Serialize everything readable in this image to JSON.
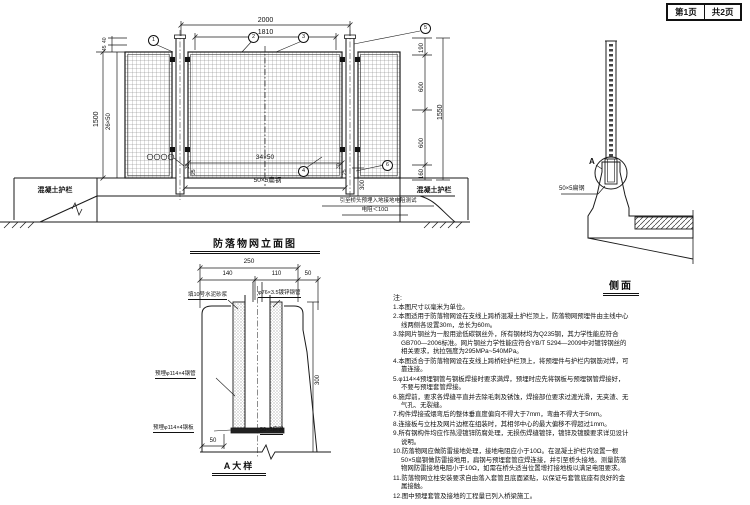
{
  "header": {
    "page": "第1页",
    "total": "共2页"
  },
  "elevation": {
    "title": "防落物网立面图",
    "dims": {
      "w2000": "2000",
      "w1810": "1810",
      "h1500": "1500",
      "mesh_v": "26×50",
      "t40": "40",
      "t45": "45",
      "r190": "190",
      "r600a": "600",
      "r1550": "1550",
      "r600b": "600",
      "r160": "160",
      "mesh_h": "34×50",
      "embed": "300",
      "g30": "30",
      "g25": "25"
    },
    "labels": {
      "flat_steel": "50×5扁钢",
      "barrier_left": "混凝土护栏",
      "barrier_right": "混凝土护栏",
      "ground_note1": "引至桥头预埋入地接地电阻测试",
      "ground_note2": "电阻＜10Ω"
    },
    "callouts": [
      "1",
      "2",
      "3",
      "4",
      "5",
      "6"
    ]
  },
  "side": {
    "title": "侧面",
    "detail_mark": "A",
    "flat_steel": "50×5扁钢"
  },
  "detail": {
    "title": "A大样",
    "dims": {
      "d250": "250",
      "d140": "140",
      "d110": "110",
      "d50": "50",
      "d300": "300",
      "d50b": "50"
    },
    "labels": {
      "mortar": "填10号水泥砂浆",
      "post_pipe": "φ76×3.5镀锌钢管",
      "sleeve_pipe": "预埋φ114×4钢管",
      "base_plate": "预埋φ114×4钢板",
      "flat_steel": "50×5扁钢"
    }
  },
  "notes": {
    "heading": "注:",
    "items": [
      "1.本图尺寸以毫米为单位。",
      "2.本图适用于防落物网设在支线上跨桥混凝土护栏顶上，防落物网预埋件由主线中心线两侧各设置30m，总长为60m。",
      "3.除网片钢丝为一般用途低碳钢丝外，所有钢材均为Q235钢，其力学性能应符合GB700—2006标准。网片钢丝力学性能应符合YB/T 5294—2009中对镀锌钢丝的相关要求，抗拉强度为295MPa~540MPa。",
      "4.本图适合于防落物网设在支线上跨桥砼护栏顶上，将预埋件与护栏内钢筋对焊，可靠连接。",
      "5.φ114×4预埋钢管与钢板焊接时要求满焊，预埋时应先将钢板与预埋钢管焊接好，不要与预埋套管焊接。",
      "6.施焊前，要求各焊缝平直并去除毛刺及锈蚀，焊接部位要求过渡光滑，无夹渣、无气孔、无裂缝。",
      "7.构件焊接或煨弯后的整体垂直度偏向不得大于7mm，弯曲不得大于5mm。",
      "8.连接板与立柱及网片边框在组装时，其相邻中心的最大偏移不得超过1mm。",
      "9.所有钢构件均应作热浸镀锌防腐处理，无损伤焊缝镀锌，镀锌及镀膜要求详见设计说明。",
      "10.防落物网应做防雷接地处理，接地电阻应小于10Ω。在混凝土护栏内设置一根50×5扁钢做防雷接地用，扁钢与预埋套管应焊连接，并引至桥头接地。测量防落物网防雷接地电阻小于10Ω，如需在桥头适当位置增打接地极以满足电阻要求。",
      "11.防落物网立柱安装要求自由落入套管且底面紧贴，以保证与套管底座有良好的金属接触。",
      "12.图中预埋套管及接地的工程量已列入桥梁施工。"
    ]
  }
}
